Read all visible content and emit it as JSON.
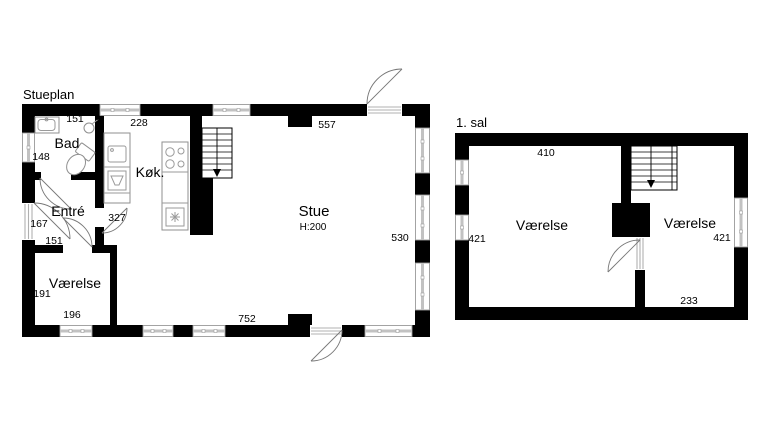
{
  "colors": {
    "wall": "#000000",
    "background": "#ffffff",
    "frame_gray": "#9a9a9a"
  },
  "ground_floor": {
    "title": "Stueplan",
    "bad": {
      "name": "Bad",
      "dim_top": "151",
      "dim_left": "148"
    },
    "kok": {
      "name": "Køk.",
      "dim_top": "228",
      "dim_bottom": "327"
    },
    "entre": {
      "name": "Entré",
      "dim_left": "167",
      "dim_bottom": "151"
    },
    "vaerelse": {
      "name": "Værelse",
      "dim_left": "191",
      "dim_bottom": "196"
    },
    "stue": {
      "name": "Stue",
      "ceiling_height": "H:200",
      "dim_top": "557",
      "dim_right": "530",
      "dim_bottom": "752"
    }
  },
  "first_floor": {
    "title": "1. sal",
    "dim_top": "410",
    "vaerelse_left": {
      "name": "Værelse",
      "dim_left": "421"
    },
    "vaerelse_right": {
      "name": "Værelse",
      "dim_right": "421",
      "dim_bottom": "233"
    }
  }
}
